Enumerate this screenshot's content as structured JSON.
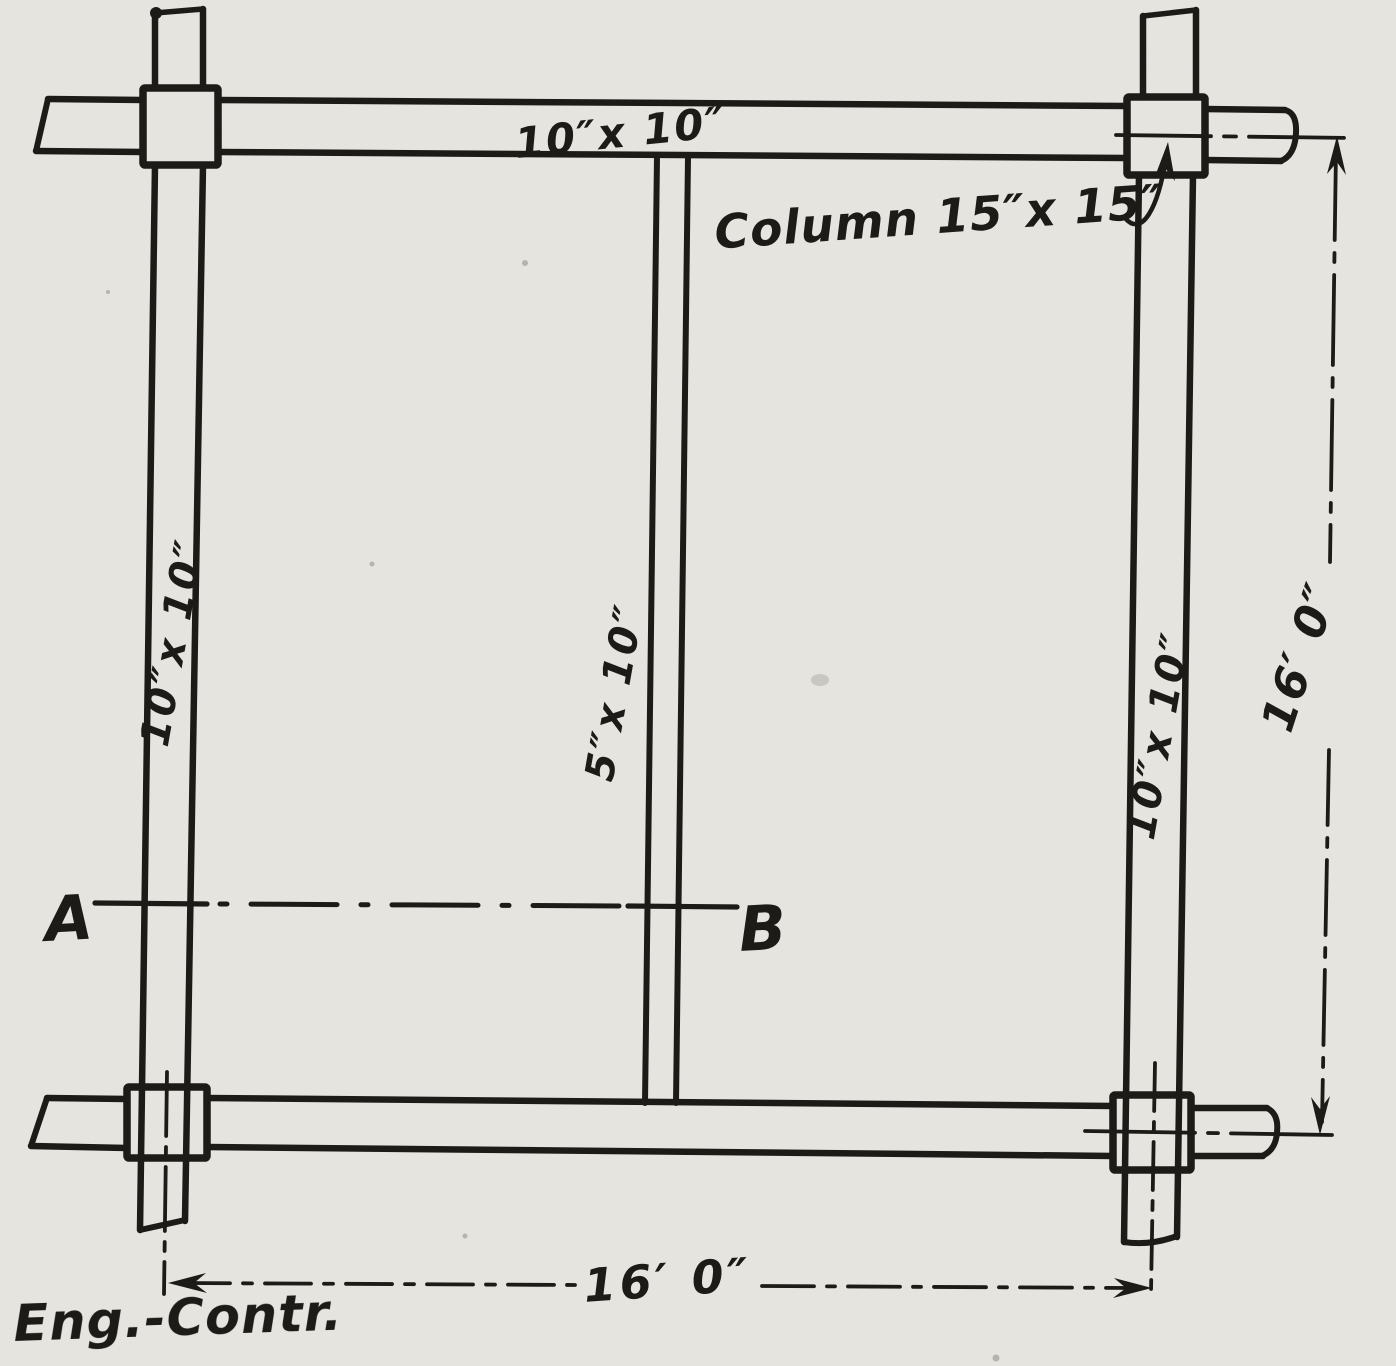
{
  "labels": {
    "top_beam": "10″x 10″",
    "left_beam": "10″x 10″",
    "right_beam": "10″x 10″",
    "middle_beam": "5″x 10″",
    "column_note": "Column 15″x 15″",
    "dim_right": "16′ 0″",
    "dim_bottom": "16′ 0″",
    "section_left": "A",
    "section_right": "B",
    "credit": "Eng.-Contr."
  },
  "colors": {
    "ink": "#1c1b17",
    "paper": "#e8e6e1"
  }
}
